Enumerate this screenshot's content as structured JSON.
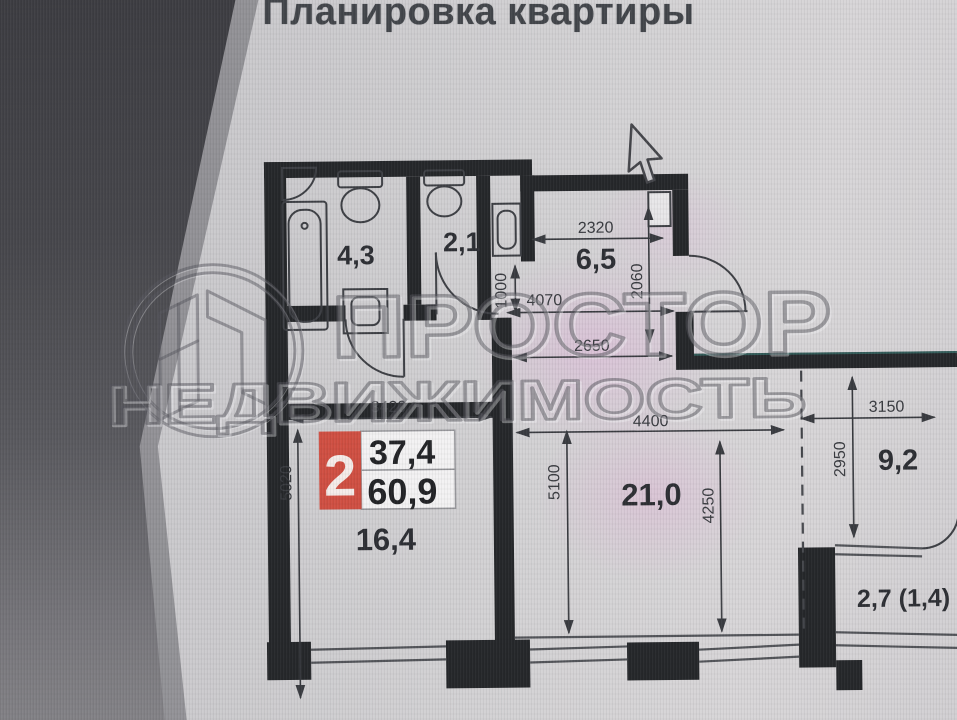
{
  "title": "Планировка квартиры",
  "watermark": {
    "logo": "prostor-realty-logo",
    "line1": "ПРОСТОР",
    "line2": "НЕДВИЖИМОСТЬ"
  },
  "apartment_badge": {
    "rooms": "2",
    "living_area": "37,4",
    "total_area": "60,9"
  },
  "rooms": {
    "bathroom": {
      "label": "4,3"
    },
    "wc": {
      "label": "2,1"
    },
    "hall": {
      "label": "6,5"
    },
    "bedroom": {
      "label": "16,4"
    },
    "living": {
      "label": "21,0"
    },
    "kitchen": {
      "label": "9,2"
    },
    "balcony": {
      "label": "2,7 (1,4)"
    }
  },
  "dimensions": {
    "hall_width": "2320",
    "hall_depth": "2060",
    "passage_width": "1000",
    "corridor_length": "4070",
    "corridor_length2": "2650",
    "bedroom_width": "3420",
    "bedroom_depth": "5020",
    "living_width": "4400",
    "living_depth_left": "5100",
    "living_depth_right": "4250",
    "kitchen_width": "3150",
    "kitchen_depth": "2950"
  },
  "icons": {
    "cursor_icon": "mouse-pointer-arrow"
  },
  "colors": {
    "wall": "#26282b",
    "badge_red": "#d05043",
    "screen_bg": "#cfcdd0",
    "shadow": "#45454a",
    "dim_text": "#3a3c41"
  }
}
